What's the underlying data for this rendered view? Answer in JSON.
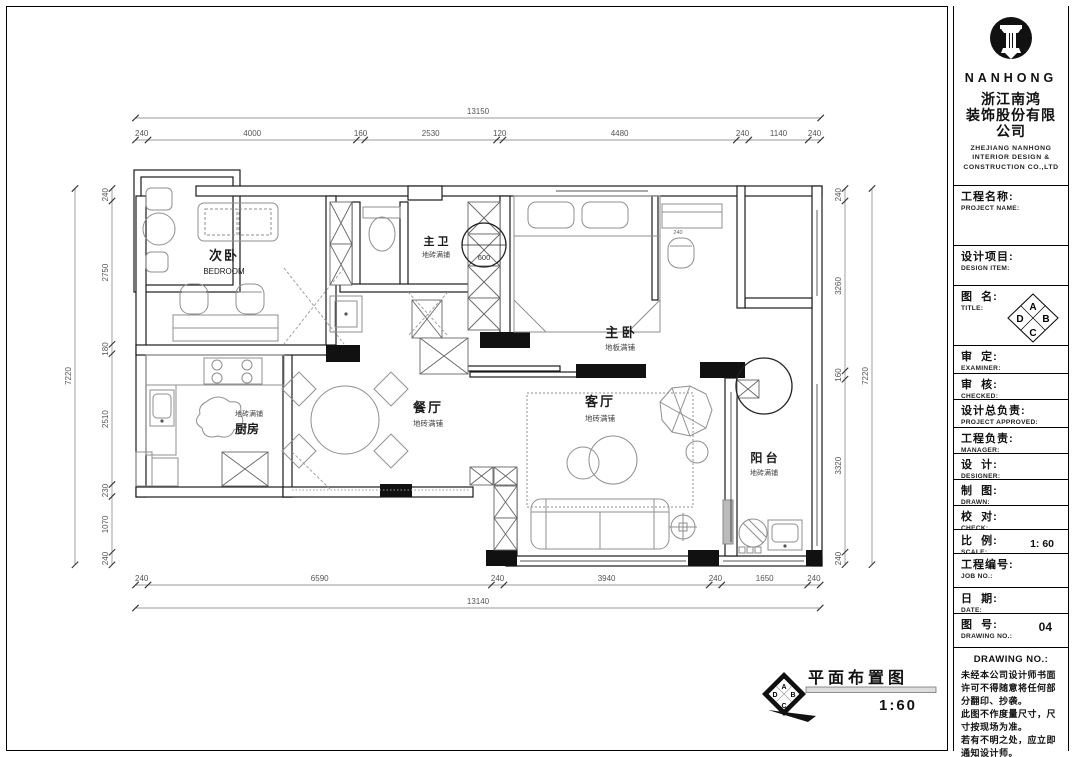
{
  "colors": {
    "ink": "#1b1b1b",
    "furniture": "#8f8f8f"
  },
  "plan": {
    "rooms": {
      "secondary_bedroom": {
        "name": "次卧",
        "sub": "BEDROOM"
      },
      "master_bath": {
        "name": "主 卫",
        "sub": "地砖满铺"
      },
      "master_bedroom": {
        "name": "主 卧",
        "sub": "地板满铺"
      },
      "dining": {
        "name": "餐厅",
        "sub": "地砖满铺"
      },
      "living": {
        "name": "客厅",
        "sub": "地砖满铺"
      },
      "kitchen": {
        "name": "厨房",
        "sub": "地砖满铺"
      },
      "balcony": {
        "name": "阳 台",
        "sub": "地砖满铺"
      }
    },
    "annotations": {
      "closet_width": "600",
      "counter_depth": "240"
    },
    "dims": {
      "top_overall": "13150",
      "top": [
        "240",
        "4000",
        "160",
        "2530",
        "120",
        "4480",
        "240",
        "1140",
        "240"
      ],
      "bottom_overall": "13140",
      "bottom": [
        "240",
        "6590",
        "240",
        "3940",
        "240",
        "1650",
        "240"
      ],
      "left_overall": "7220",
      "left": [
        "240",
        "2750",
        "180",
        "2510",
        "230",
        "1070",
        "240"
      ],
      "right_overall": "7220",
      "right": [
        "240",
        "3260",
        "160",
        "3320",
        "240"
      ]
    }
  },
  "footer": {
    "drawing_title": "平面布置图",
    "scale_text": "1:60"
  },
  "title_block": {
    "logo_text": "NANHONG",
    "company_cn1": "浙江南鸿",
    "company_cn2": "装饰股份有限公司",
    "company_en1": "ZHEJIANG NANHONG",
    "company_en2": "INTERIOR DESIGN &",
    "company_en3": "CONSTRUCTION CO.,LTD",
    "symbol": {
      "a": "A",
      "b": "B",
      "c": "C",
      "d": "D"
    },
    "fields": [
      {
        "cn": "工程名称:",
        "en": "PROJECT NAME:",
        "value": ""
      },
      {
        "cn": "设计项目:",
        "en": "DESIGN ITEM:",
        "value": ""
      },
      {
        "cn": "图  名:",
        "en": "TITLE:",
        "value": ""
      },
      {
        "cn": "审  定:",
        "en": "EXAMINER:",
        "value": ""
      },
      {
        "cn": "审  核:",
        "en": "CHECKED:",
        "value": ""
      },
      {
        "cn": "设计总负责:",
        "en": "PROJECT APPROVED:",
        "value": ""
      },
      {
        "cn": "工程负责:",
        "en": "MANAGER:",
        "value": ""
      },
      {
        "cn": "设  计:",
        "en": "DESIGNER:",
        "value": ""
      },
      {
        "cn": "制  图:",
        "en": "DRAWN:",
        "value": ""
      },
      {
        "cn": "校  对:",
        "en": "CHECK:",
        "value": ""
      },
      {
        "cn": "比  例:",
        "en": "SCALE:",
        "value": "1: 60"
      },
      {
        "cn": "工程编号:",
        "en": "JOB  NO.:",
        "value": ""
      },
      {
        "cn": "日  期:",
        "en": "DATE:",
        "value": ""
      },
      {
        "cn": "图  号:",
        "en": "DRAWING NO.:",
        "value": "04"
      }
    ],
    "notice_title": "DRAWING NO.:",
    "notice_lines": [
      "未经本公司设计师书面",
      "许可不得随意将任何部",
      "分翻印、抄袭。",
      "此图不作度量尺寸，尺",
      "寸按现场为准。",
      "若有不明之处，应立即",
      "通知设计师。"
    ]
  }
}
